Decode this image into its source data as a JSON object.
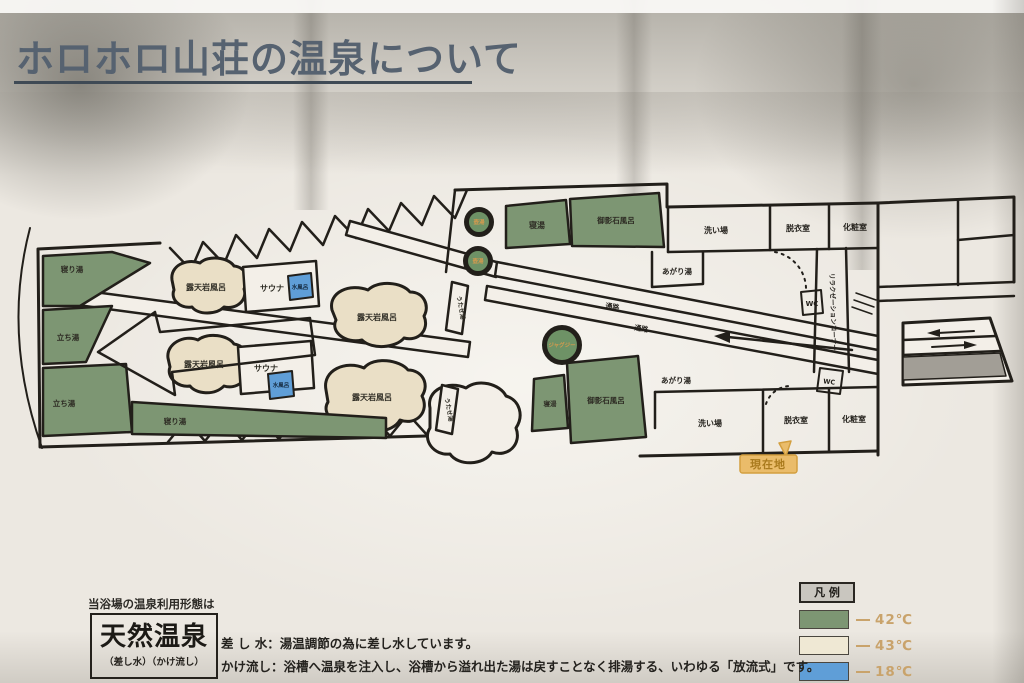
{
  "title": "ホロホロ山荘の温泉について",
  "map": {
    "corner_bath": "寝り湯",
    "standing_bath": "立ち湯",
    "rock_bath": "露天岩風呂",
    "sauna": "サウナ",
    "cold_bath": "水風呂",
    "utase_bath": "うたせ湯",
    "pot_bath": "壺湯",
    "lying_bath": "寝湯",
    "granite_bath": "御影石風呂",
    "jacuzzi": "ジャグジー",
    "agari_bath": "あがり湯",
    "passage": "通路",
    "washing_area": "洗い場",
    "dressing_room": "脱衣室",
    "powder_room": "化粧室",
    "relaxation_corner": "リラクゼーションコーナー",
    "wc": "WC",
    "you_are_here": "現在地"
  },
  "legend": {
    "title": "凡 例",
    "items": [
      {
        "color": "#7d9673",
        "label": "42℃"
      },
      {
        "color": "#efe8d4",
        "label": "43℃"
      },
      {
        "color": "#5f9ed7",
        "label": "18℃"
      }
    ]
  },
  "info": {
    "heading": "当浴場の温泉利用形態は",
    "box_title": "天然温泉",
    "box_subtitle": "（差し水）（かけ流し）",
    "line1": "差 し 水：湯温調節の為に差し水しています。",
    "line2": "かけ流し：浴槽へ温泉を注入し、浴槽から溢れ出た湯は戻すことなく排湯する、いわゆる「放流式」です。"
  }
}
